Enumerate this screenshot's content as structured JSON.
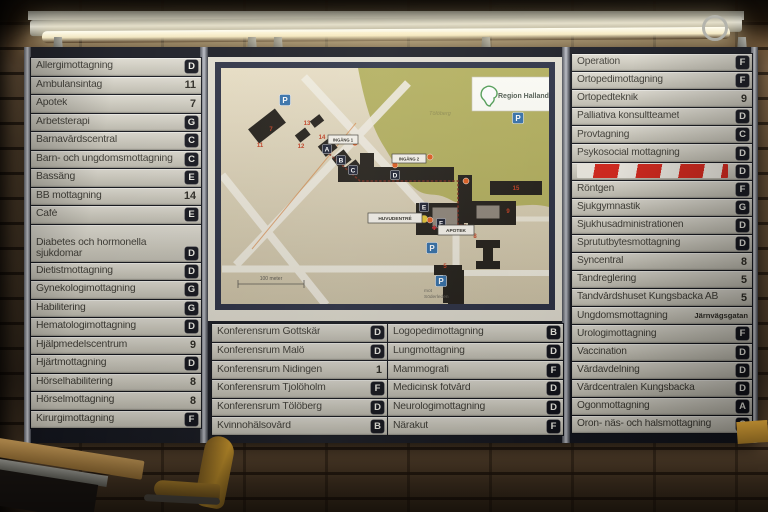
{
  "sign": {
    "lists": {
      "left": [
        {
          "label": "Allergimottagning",
          "code": "D",
          "type": "letter"
        },
        {
          "label": "Ambulansintag",
          "code": "11",
          "type": "number"
        },
        {
          "label": "Apotek",
          "code": "7",
          "type": "number"
        },
        {
          "label": "Arbetsterapi",
          "code": "G",
          "type": "letter"
        },
        {
          "label": "Barnavårdscentral",
          "code": "C",
          "type": "letter"
        },
        {
          "label": "Barn- och ungdomsmottagning",
          "code": "C",
          "type": "letter"
        },
        {
          "label": "Bassäng",
          "code": "E",
          "type": "letter"
        },
        {
          "label": "BB mottagning",
          "code": "14",
          "type": "number"
        },
        {
          "label": "Café",
          "code": "E",
          "type": "letter"
        },
        {
          "label": "Diabetes och hormonella sjukdomar",
          "code": "D",
          "type": "letter",
          "tall": true
        },
        {
          "label": "Dietistmottagning",
          "code": "D",
          "type": "letter"
        },
        {
          "label": "Gynekologimottagning",
          "code": "G",
          "type": "letter"
        },
        {
          "label": "Habilitering",
          "code": "G",
          "type": "letter"
        },
        {
          "label": "Hematologimottagning",
          "code": "D",
          "type": "letter"
        },
        {
          "label": "Hjälpmedelscentrum",
          "code": "9",
          "type": "number"
        },
        {
          "label": "Hjärtmottagning",
          "code": "D",
          "type": "letter"
        },
        {
          "label": "Hörselhabilitering",
          "code": "8",
          "type": "number"
        },
        {
          "label": "Hörselmottagning",
          "code": "8",
          "type": "number"
        },
        {
          "label": "Kirurgimottagning",
          "code": "F",
          "type": "letter"
        }
      ],
      "mid_left": [
        {
          "label": "Konferensrum Gottskär",
          "code": "D",
          "type": "letter"
        },
        {
          "label": "Konferensrum Malö",
          "code": "D",
          "type": "letter"
        },
        {
          "label": "Konferensrum Nidingen",
          "code": "1",
          "type": "number"
        },
        {
          "label": "Konferensrum Tjolöholm",
          "code": "F",
          "type": "letter"
        },
        {
          "label": "Konferensrum Tölöberg",
          "code": "D",
          "type": "letter"
        },
        {
          "label": "Kvinnohälsovård",
          "code": "B",
          "type": "letter"
        }
      ],
      "mid_right": [
        {
          "label": "Logopedimottagning",
          "code": "B",
          "type": "letter"
        },
        {
          "label": "Lungmottagning",
          "code": "D",
          "type": "letter"
        },
        {
          "label": "Mammografi",
          "code": "F",
          "type": "letter"
        },
        {
          "label": "Medicinsk fotvård",
          "code": "D",
          "type": "letter"
        },
        {
          "label": "Neurologimottagning",
          "code": "D",
          "type": "letter"
        },
        {
          "label": "Närakut",
          "code": "F",
          "type": "letter"
        }
      ],
      "right": [
        {
          "label": "Operation",
          "code": "F",
          "type": "letter"
        },
        {
          "label": "Ortopedimottagning",
          "code": "F",
          "type": "letter"
        },
        {
          "label": "Ortopedteknik",
          "code": "9",
          "type": "number"
        },
        {
          "label": "Palliativa konsultteamet",
          "code": "D",
          "type": "letter"
        },
        {
          "label": "Provtagning",
          "code": "C",
          "type": "letter"
        },
        {
          "label": "Psykosocial mottagning",
          "code": "D",
          "type": "letter"
        },
        {
          "label": "",
          "code": "D",
          "type": "letter",
          "covered": true
        },
        {
          "label": "Röntgen",
          "code": "F",
          "type": "letter"
        },
        {
          "label": "Sjukgymnastik",
          "code": "G",
          "type": "letter"
        },
        {
          "label": "Sjukhusadministrationen",
          "code": "D",
          "type": "letter"
        },
        {
          "label": "Sprututbytesmottagning",
          "code": "D",
          "type": "letter"
        },
        {
          "label": "Syncentral",
          "code": "8",
          "type": "number"
        },
        {
          "label": "Tandreglering",
          "code": "5",
          "type": "number"
        },
        {
          "label": "Tandvårdshuset Kungsbacka AB",
          "code": "5",
          "type": "number"
        },
        {
          "label": "Ungdomsmottagning",
          "code": "Järnvägsgatan",
          "type": "text"
        },
        {
          "label": "Urologimottagning",
          "code": "F",
          "type": "letter"
        },
        {
          "label": "Vaccination",
          "code": "D",
          "type": "letter"
        },
        {
          "label": "Vårdavdelning",
          "code": "D",
          "type": "letter"
        },
        {
          "label": "Vårdcentralen Kungsbacka",
          "code": "D",
          "type": "letter"
        },
        {
          "label": "Ögonmottagning",
          "code": "A",
          "type": "letter"
        },
        {
          "label": "Öron- näs- och halsmottagning",
          "code": "C",
          "type": "letter"
        }
      ]
    },
    "map": {
      "logo": "Region Halland",
      "hill_label": "Tölöberg",
      "scale_label": "100 meter",
      "road_note_line1": "mot",
      "road_note_line2": "Söderleden",
      "parking_letter": "P",
      "labels": [
        {
          "text": "INGÅNG 1",
          "x": 120,
          "y": 78,
          "w": 30,
          "h": 9,
          "fs": 4.2
        },
        {
          "text": "INGÅNG 2",
          "x": 184,
          "y": 97,
          "w": 34,
          "h": 9,
          "fs": 4.2
        },
        {
          "text": "HUVUDENTRÉ",
          "x": 160,
          "y": 156,
          "w": 54,
          "h": 10,
          "fs": 4.8
        },
        {
          "text": "APOTEK",
          "x": 230,
          "y": 168,
          "w": 36,
          "h": 10,
          "fs": 4.8
        }
      ],
      "building_letters": [
        {
          "t": "A",
          "x": 119,
          "y": 92
        },
        {
          "t": "B",
          "x": 133,
          "y": 103
        },
        {
          "t": "C",
          "x": 145,
          "y": 113
        },
        {
          "t": "D",
          "x": 187,
          "y": 118
        },
        {
          "t": "E",
          "x": 216,
          "y": 150
        },
        {
          "t": "F",
          "x": 233,
          "y": 166
        }
      ],
      "building_numbers": [
        {
          "t": "7",
          "x": 63,
          "y": 74
        },
        {
          "t": "11",
          "x": 52,
          "y": 90
        },
        {
          "t": "12",
          "x": 93,
          "y": 91
        },
        {
          "t": "13",
          "x": 99,
          "y": 68
        },
        {
          "t": "14",
          "x": 114,
          "y": 82
        },
        {
          "t": "15",
          "x": 308,
          "y": 133
        },
        {
          "t": "8",
          "x": 267,
          "y": 181
        },
        {
          "t": "9",
          "x": 300,
          "y": 156
        },
        {
          "t": "5",
          "x": 237,
          "y": 211
        }
      ],
      "parking": [
        [
          77,
          43
        ],
        [
          310,
          61
        ],
        [
          224,
          191
        ],
        [
          233,
          224
        ]
      ],
      "entrance_dots": [
        [
          147,
          86
        ],
        [
          187,
          108
        ],
        [
          222,
          163
        ],
        [
          222,
          100
        ],
        [
          258,
          124
        ]
      ]
    },
    "colors": {
      "badge_bg": "#101119",
      "row_light": "#dedbd1",
      "row_dark": "#bdbaae",
      "map_navy": "#272c40",
      "map_beige": "#ddd3b8",
      "hill_green": "#b2ae5a",
      "parking_blue": "#2f6da8",
      "hazard_red": "#d42015",
      "logo_green": "#4a9a4f"
    }
  }
}
